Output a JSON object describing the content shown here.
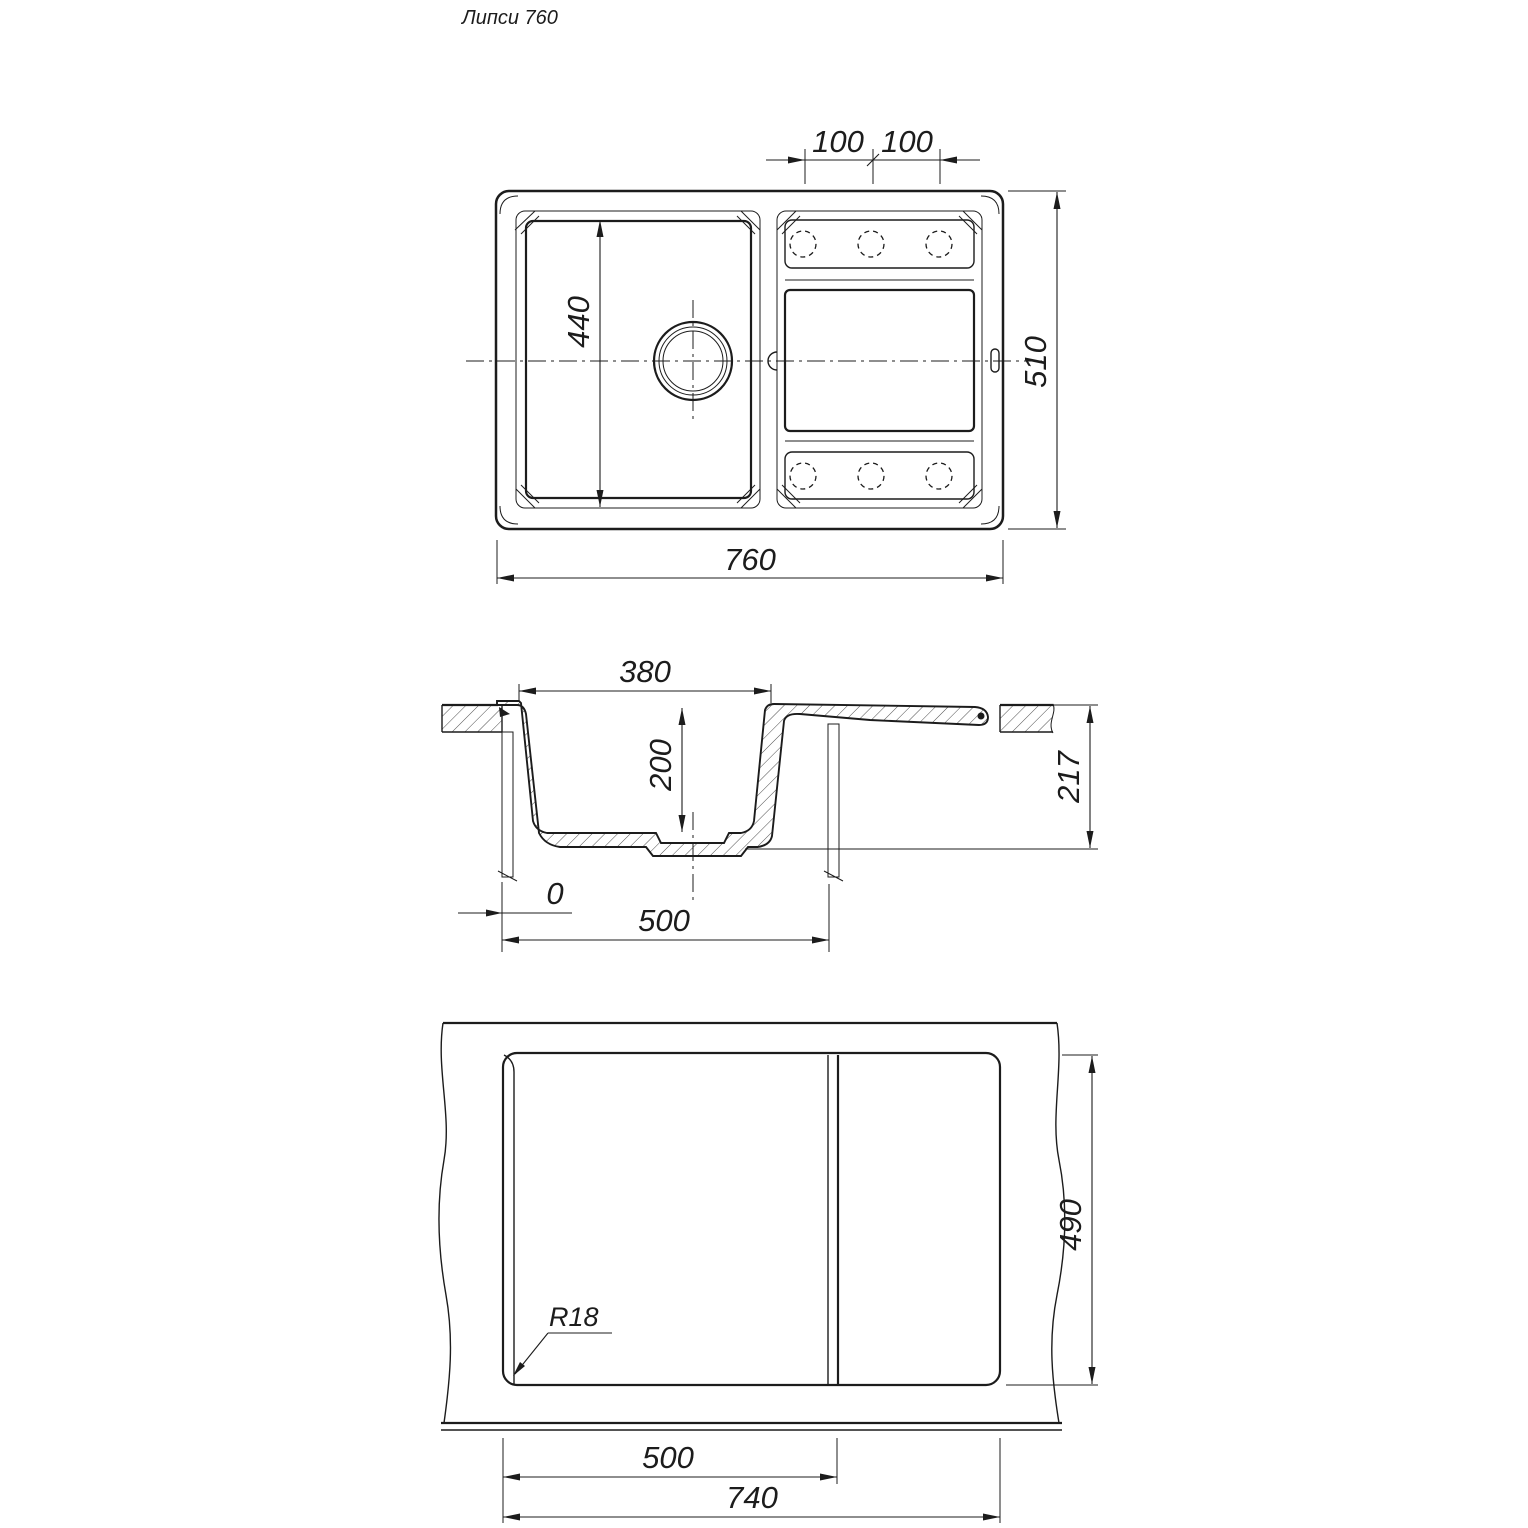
{
  "title": "Липси 760",
  "colors": {
    "line": "#1c1c1c",
    "background": "#ffffff"
  },
  "top_view": {
    "hole_spacing_left": "100",
    "hole_spacing_right": "100",
    "bowl_length": "440",
    "overall_width": "760",
    "overall_depth": "510"
  },
  "section_view": {
    "bowl_width": "380",
    "bowl_depth": "200",
    "overall_height": "217",
    "edge_offset": "0",
    "cabinet_width": "500"
  },
  "bottom_view": {
    "corner_radius": "R18",
    "cutout_depth": "490",
    "drain_offset": "500",
    "cutout_width": "740"
  }
}
